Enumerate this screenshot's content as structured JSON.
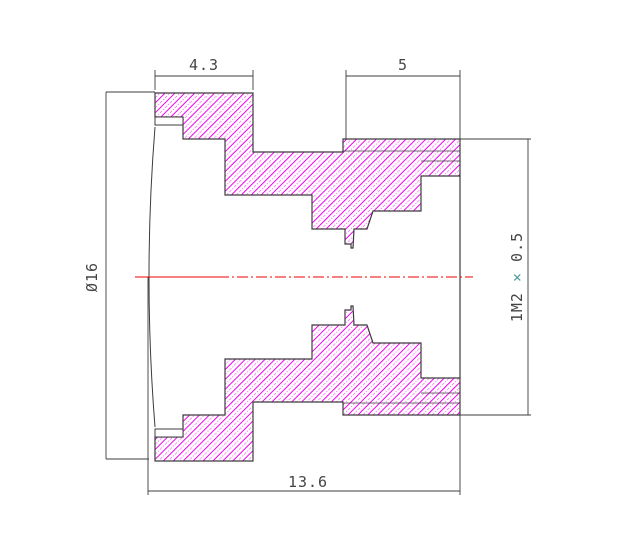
{
  "drawing": {
    "labels": {
      "flange_width": "4.3",
      "thread_length": "5",
      "overall_length": "13.6",
      "outer_diameter": "Ø16",
      "thread_spec_prefix": "1M2 ",
      "thread_spec_times": "×",
      "thread_spec_suffix": "0.5"
    },
    "colors": {
      "outline": "#3c3c3c",
      "text": "#454545",
      "hatch": "#f200f2",
      "centerline": "#ec0000",
      "times_symbol": "#4f9b9b",
      "background": "#ffffff"
    }
  }
}
